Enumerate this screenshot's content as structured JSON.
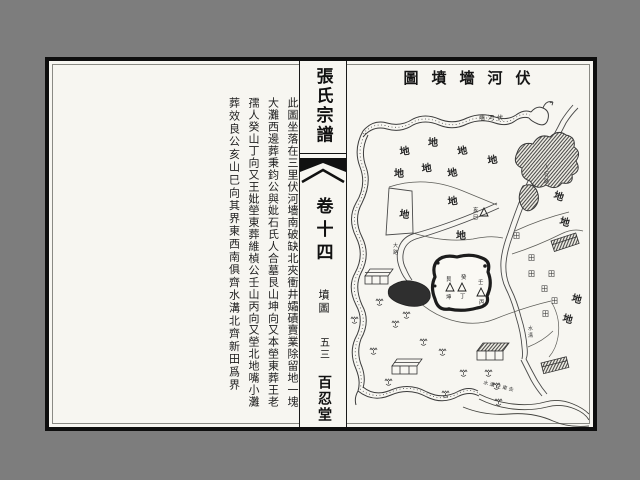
{
  "page": {
    "background": "#7d7d7d",
    "paper_color": "#f7f6f1"
  },
  "spine": {
    "title": "張氏宗譜",
    "volume": "卷十四",
    "section": "墳圖",
    "page_number": "五三",
    "hall": "百忍堂"
  },
  "description_columns": [
    "此圖坐落在三里伏河墻南破缺北夾衝井孀磧賣業除留地一塊",
    "大灘西邊葬秉鈞公與妣石氏人合墓艮山坤向又本塋東葬王老",
    "孺人癸山丁向又王妣塋東葬維楨公壬山丙向又塋北地嘴小灘",
    "葬效良公亥山巳向其界東西南俱齊水溝北齊新田爲界"
  ],
  "map": {
    "title": "圖墳墻河伏",
    "small_labels": {
      "wall": "墻河伏",
      "path": "人行路",
      "ditch": "水溝",
      "road": "大路",
      "stream": "水溝往東去"
    },
    "land_labels": {
      "char": "地",
      "positions": [
        [
          55,
          64,
          -6
        ],
        [
          83,
          55,
          0
        ],
        [
          113,
          64,
          -10
        ],
        [
          143,
          73,
          -8
        ],
        [
          49,
          86,
          0
        ],
        [
          77,
          81,
          -6
        ],
        [
          103,
          86,
          -10
        ],
        [
          54,
          126,
          8
        ],
        [
          103,
          114,
          -6
        ],
        [
          111,
          148,
          0
        ],
        [
          208,
          107,
          18
        ],
        [
          214,
          133,
          15
        ],
        [
          226,
          210,
          15
        ],
        [
          217,
          230,
          15
        ]
      ]
    },
    "field_labels": {
      "char": "田",
      "positions": [
        [
          168,
          147,
          0
        ],
        [
          183,
          169,
          0
        ],
        [
          183,
          185,
          0
        ],
        [
          203,
          185,
          0
        ],
        [
          196,
          200,
          0
        ],
        [
          206,
          212,
          0
        ],
        [
          197,
          225,
          0
        ]
      ]
    },
    "graves": [
      {
        "top": "艮",
        "bottom": "坤"
      },
      {
        "top": "癸",
        "bottom": "丁"
      },
      {
        "top": "壬",
        "bottom": "丙"
      },
      {
        "top": "亥",
        "bottom": "巳"
      }
    ]
  }
}
